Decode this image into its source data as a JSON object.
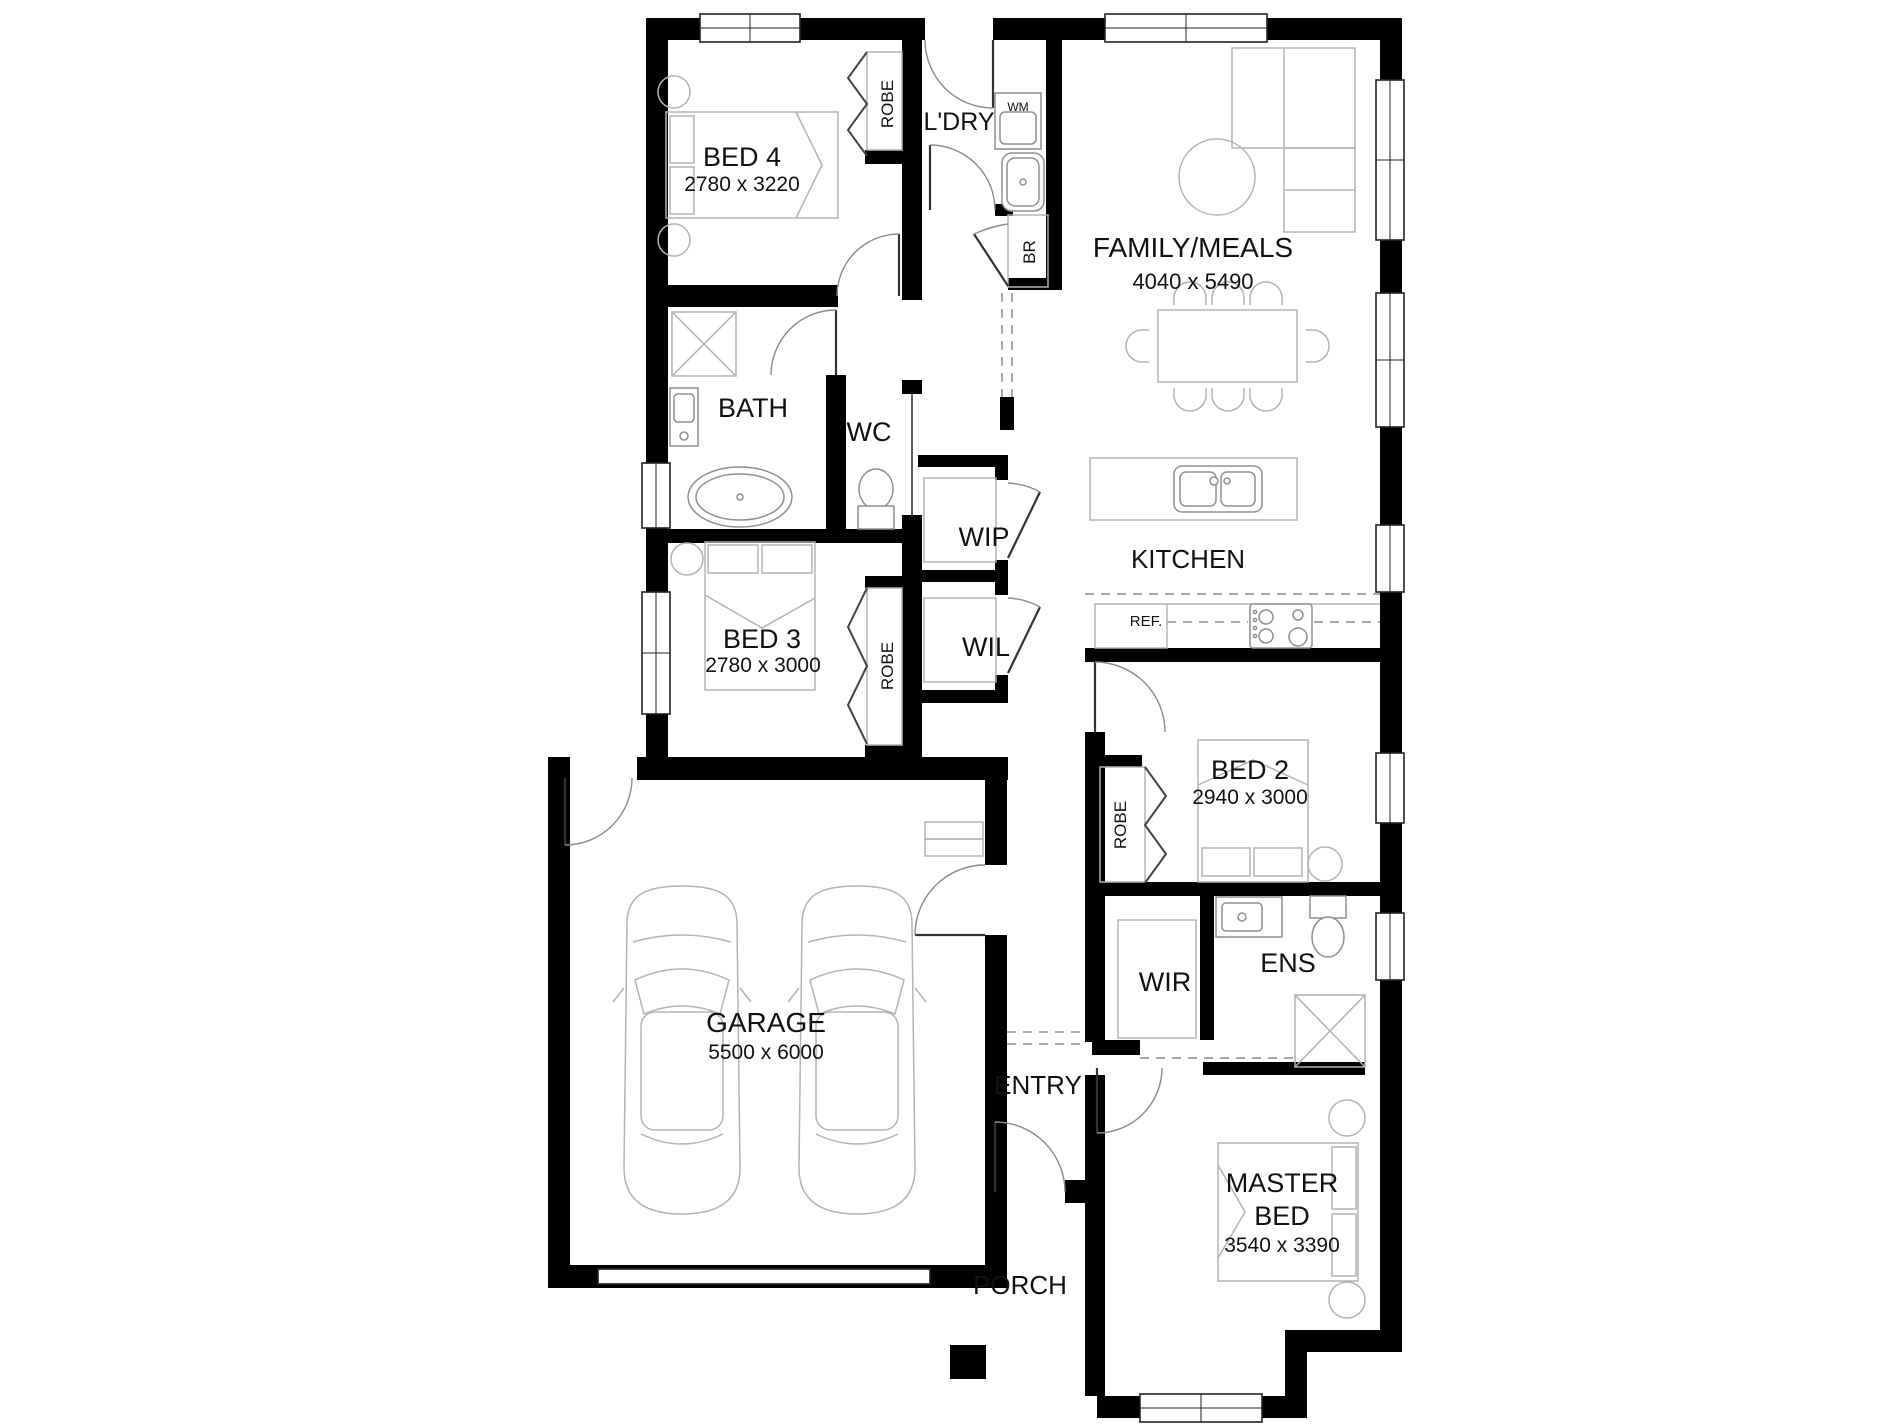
{
  "rooms": {
    "bed4": {
      "name": "BED 4",
      "dims": "2780 x 3220"
    },
    "ldry": {
      "name": "L'DRY"
    },
    "family": {
      "name": "FAMILY/MEALS",
      "dims": "4040 x 5490"
    },
    "bath": {
      "name": "BATH"
    },
    "wc": {
      "name": "WC"
    },
    "wip": {
      "name": "WIP"
    },
    "wil": {
      "name": "WIL"
    },
    "kitchen": {
      "name": "KITCHEN"
    },
    "bed3": {
      "name": "BED 3",
      "dims": "2780 x 3000"
    },
    "bed2": {
      "name": "BED 2",
      "dims": "2940 x 3000"
    },
    "wir": {
      "name": "WIR"
    },
    "ens": {
      "name": "ENS"
    },
    "garage": {
      "name": "GARAGE",
      "dims": "5500 x 6000"
    },
    "entry": {
      "name": "ENTRY"
    },
    "master": {
      "name_line1": "MASTER",
      "name_line2": "BED",
      "dims": "3540 x 3390"
    },
    "porch": {
      "name": "PORCH"
    }
  },
  "fixtures": {
    "robe_bed4": "ROBE",
    "robe_bed3": "ROBE",
    "robe_bed2": "ROBE",
    "wm": "WM",
    "br": "BR",
    "ref": "REF."
  },
  "colors": {
    "wall": "#000000",
    "furniture": "#b3b3b3",
    "text": "#111111",
    "background": "#ffffff"
  }
}
